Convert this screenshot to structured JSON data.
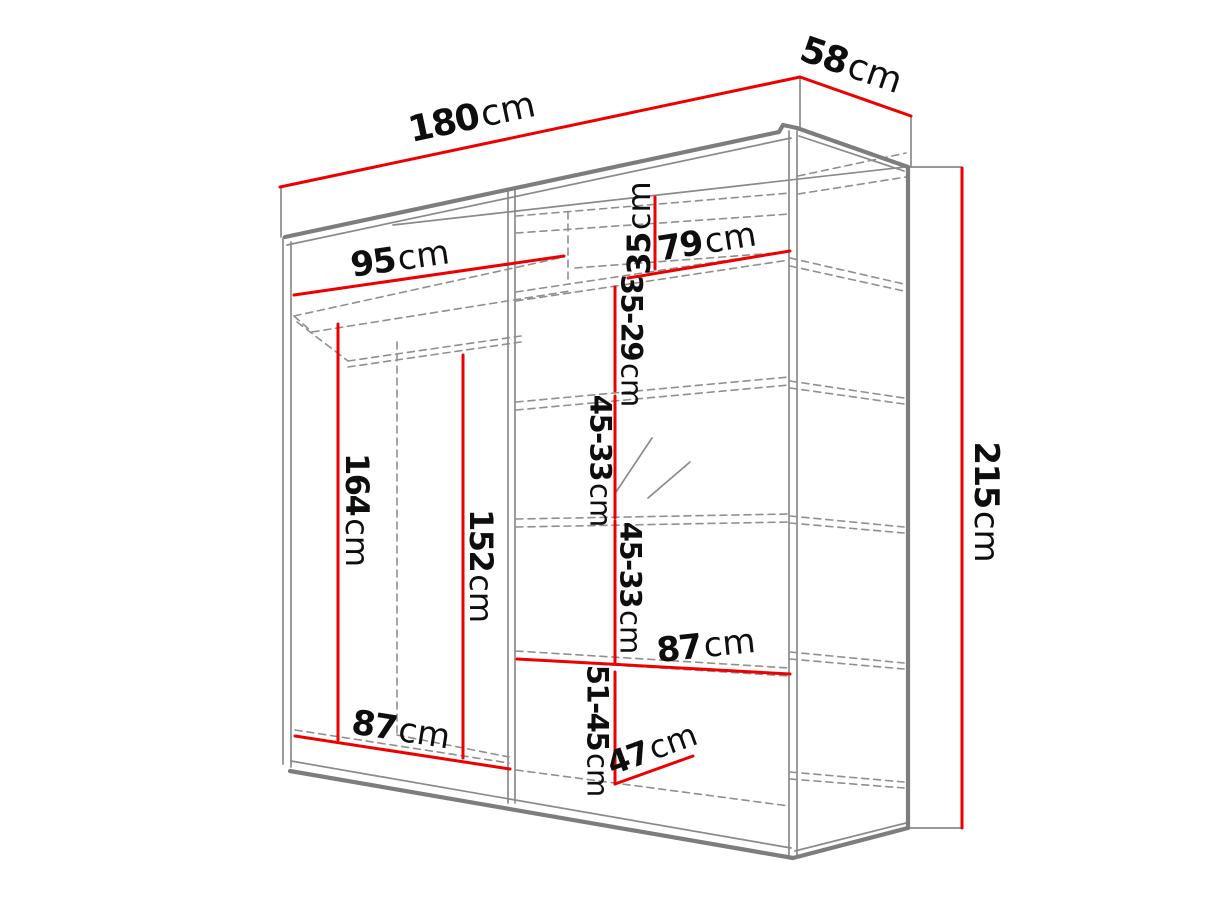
{
  "colors": {
    "background": "#ffffff",
    "dimension_red": "#ee0000",
    "outline_gray": "#7d7d7d",
    "thin_gray": "#8a8a8a",
    "dashed_gray": "#8f8f8f",
    "label_black": "#0e0e0e"
  },
  "diagram": {
    "type": "furniture-dimension-diagram",
    "subject": "Sliding-door wardrobe shown in perspective with overall and interior dimensions in centimetres",
    "overall": {
      "width": "180cm",
      "depth": "58cm",
      "height": "215cm"
    },
    "dimensions": [
      {
        "id": "width-total",
        "value": "180",
        "unit": "cm",
        "line": {
          "x1": 280,
          "y1": 187,
          "x2": 800,
          "y2": 77
        },
        "label": {
          "x": 472,
          "y": 118,
          "rot": -12,
          "size": 36
        }
      },
      {
        "id": "depth-total",
        "value": "58",
        "unit": "cm",
        "line": {
          "x1": 800,
          "y1": 77,
          "x2": 911,
          "y2": 116
        },
        "label": {
          "x": 851,
          "y": 66,
          "rot": 19,
          "size": 36
        }
      },
      {
        "id": "height-total",
        "value": "215",
        "unit": "cm",
        "line": {
          "x1": 962,
          "y1": 168,
          "x2": 962,
          "y2": 828
        },
        "label": {
          "x": 986,
          "y": 502,
          "rot": 90,
          "size": 34
        }
      },
      {
        "id": "left-width-top",
        "value": "95",
        "unit": "cm",
        "line": {
          "x1": 294,
          "y1": 295,
          "x2": 564,
          "y2": 256
        },
        "label": {
          "x": 400,
          "y": 259,
          "rot": -8,
          "size": 34
        }
      },
      {
        "id": "top-shelf-height",
        "value": "35",
        "unit": "cm",
        "line": {
          "x1": 655,
          "y1": 197,
          "x2": 655,
          "y2": 269
        },
        "label": {
          "x": 639,
          "y": 228,
          "rot": -90,
          "size": 32
        }
      },
      {
        "id": "right-width-top",
        "value": "79",
        "unit": "cm",
        "line": {
          "x1": 628,
          "y1": 278,
          "x2": 790,
          "y2": 251
        },
        "label": {
          "x": 707,
          "y": 242,
          "rot": -9,
          "size": 34
        }
      },
      {
        "id": "shelf-gap-1",
        "value": "35-29",
        "unit": "cm",
        "line": {
          "x1": 615,
          "y1": 287,
          "x2": 615,
          "y2": 391
        },
        "label": {
          "x": 631,
          "y": 341,
          "rot": 90,
          "size": 29
        }
      },
      {
        "id": "shelf-gap-2",
        "value": "45-33",
        "unit": "cm",
        "line": {
          "x1": 615,
          "y1": 396,
          "x2": 615,
          "y2": 518
        },
        "label": {
          "x": 600,
          "y": 461,
          "rot": 90,
          "size": 29
        }
      },
      {
        "id": "shelf-gap-3",
        "value": "45-33",
        "unit": "cm",
        "line": {
          "x1": 615,
          "y1": 521,
          "x2": 615,
          "y2": 663
        },
        "label": {
          "x": 630,
          "y": 588,
          "rot": 90,
          "size": 29
        }
      },
      {
        "id": "shelf-gap-4",
        "value": "51-45",
        "unit": "cm",
        "line": {
          "x1": 615,
          "y1": 672,
          "x2": 615,
          "y2": 784
        },
        "label": {
          "x": 597,
          "y": 731,
          "rot": 90,
          "size": 29
        }
      },
      {
        "id": "right-width-lower",
        "value": "87",
        "unit": "cm",
        "line": {
          "x1": 517,
          "y1": 659,
          "x2": 790,
          "y2": 674
        },
        "label": {
          "x": 706,
          "y": 646,
          "rot": -6,
          "size": 34
        }
      },
      {
        "id": "left-width-bottom",
        "value": "87",
        "unit": "cm",
        "line": {
          "x1": 295,
          "y1": 736,
          "x2": 510,
          "y2": 769
        },
        "label": {
          "x": 401,
          "y": 730,
          "rot": 9,
          "size": 34
        }
      },
      {
        "id": "rod-height",
        "value": "164",
        "unit": "cm",
        "line": {
          "x1": 338,
          "y1": 324,
          "x2": 338,
          "y2": 740
        },
        "label": {
          "x": 357,
          "y": 510,
          "rot": 90,
          "size": 32
        }
      },
      {
        "id": "left-clear-height",
        "value": "152",
        "unit": "cm",
        "line": {
          "x1": 463,
          "y1": 355,
          "x2": 463,
          "y2": 758
        },
        "label": {
          "x": 481,
          "y": 566,
          "rot": 90,
          "size": 32
        }
      },
      {
        "id": "bottom-depth",
        "value": "47",
        "unit": "cm",
        "line": {
          "x1": 615,
          "y1": 784,
          "x2": 693,
          "y2": 756
        },
        "label": {
          "x": 652,
          "y": 749,
          "rot": -20,
          "size": 32
        }
      }
    ],
    "outline_thick": [
      [
        285,
        237,
        779,
        132
      ],
      [
        779,
        132,
        783,
        125
      ],
      [
        783,
        125,
        797,
        128
      ],
      [
        797,
        128,
        908,
        167
      ],
      [
        908,
        167,
        908,
        828
      ],
      [
        908,
        828,
        793,
        858
      ],
      [
        793,
        858,
        290,
        771
      ]
    ],
    "lines_thin": [
      [
        283,
        238,
        283,
        764
      ],
      [
        291,
        242,
        291,
        767
      ],
      [
        508,
        189,
        508,
        803
      ],
      [
        515,
        188,
        515,
        803
      ],
      [
        789,
        131,
        789,
        855
      ],
      [
        797,
        131,
        797,
        856
      ],
      [
        287,
        245,
        791,
        138
      ],
      [
        799,
        136,
        904,
        171
      ],
      [
        393,
        225,
        905,
        167
      ],
      [
        281,
        187,
        281,
        237
      ],
      [
        800,
        77,
        800,
        128
      ],
      [
        911,
        116,
        911,
        166
      ],
      [
        908,
        167,
        961,
        167
      ],
      [
        908,
        828,
        961,
        828
      ],
      [
        291,
        761,
        791,
        848
      ],
      [
        795,
        851,
        906,
        823
      ],
      [
        616,
        492,
        652,
        438
      ],
      [
        648,
        498,
        690,
        462
      ]
    ],
    "lines_dashed": [
      [
        294,
        316,
        564,
        257
      ],
      [
        294,
        316,
        312,
        332
      ],
      [
        312,
        332,
        570,
        291
      ],
      [
        297,
        322,
        348,
        361
      ],
      [
        348,
        361,
        521,
        336
      ],
      [
        348,
        367,
        521,
        342
      ],
      [
        397,
        342,
        397,
        735
      ],
      [
        295,
        730,
        509,
        763
      ],
      [
        397,
        735,
        509,
        757
      ],
      [
        568,
        212,
        568,
        281
      ],
      [
        516,
        216,
        790,
        193
      ],
      [
        516,
        233,
        790,
        214
      ],
      [
        798,
        176,
        906,
        153
      ],
      [
        798,
        194,
        906,
        177
      ],
      [
        575,
        268,
        789,
        252
      ],
      [
        516,
        292,
        789,
        251
      ],
      [
        516,
        301,
        789,
        260
      ],
      [
        790,
        258,
        904,
        284
      ],
      [
        790,
        266,
        904,
        291
      ],
      [
        516,
        402,
        789,
        377
      ],
      [
        516,
        410,
        789,
        385
      ],
      [
        790,
        381,
        904,
        398
      ],
      [
        790,
        388,
        904,
        404
      ],
      [
        516,
        519,
        789,
        514
      ],
      [
        516,
        527,
        789,
        522
      ],
      [
        790,
        516,
        904,
        527
      ],
      [
        790,
        523,
        904,
        533
      ],
      [
        516,
        651,
        789,
        668
      ],
      [
        516,
        659,
        789,
        676
      ],
      [
        790,
        652,
        904,
        663
      ],
      [
        790,
        659,
        904,
        669
      ],
      [
        516,
        770,
        789,
        806
      ],
      [
        790,
        772,
        904,
        782
      ],
      [
        790,
        779,
        904,
        788
      ]
    ]
  }
}
